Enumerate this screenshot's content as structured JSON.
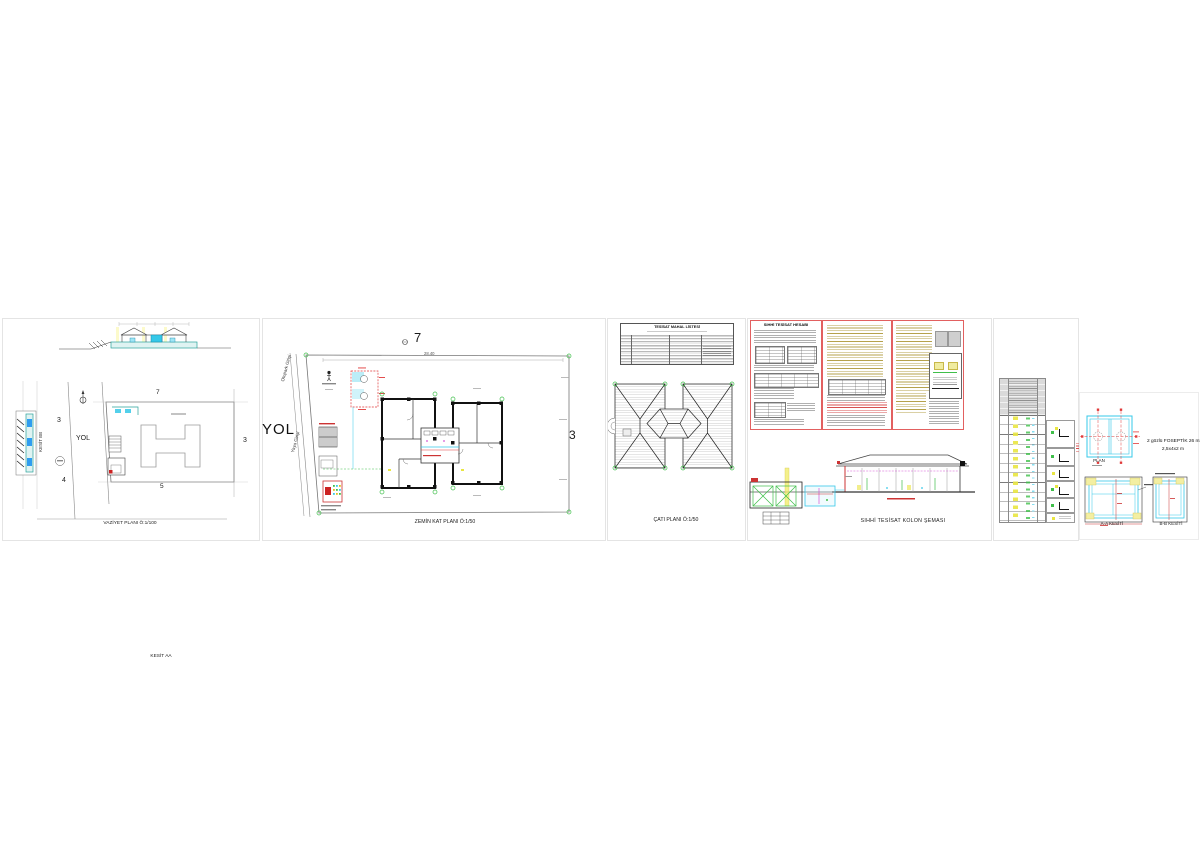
{
  "document": {
    "type": "architectural-drawing-sheet-set",
    "background": "#ffffff"
  },
  "panels": {
    "vaziyet": {
      "caption": "VAZİYET PLANI Ö:1/100",
      "section_a_label": "KESİT AA",
      "section_b_label": "KESİT BB",
      "road_label": "YOL",
      "parcel_top": "7",
      "parcel_left": "3",
      "parcel_right": "3",
      "parcel_bottom": "5",
      "parcel_bottom_left": "4"
    },
    "zemin": {
      "caption": "ZEMİN KAT PLANI Ö:1/50",
      "road_label": "YOL",
      "parcel_top": "7",
      "parcel_right": "3",
      "top_dimension": "28.40",
      "entrance_parking": "Otopark Girişi",
      "entrance_pedestrian": "Yaya Girişi"
    },
    "cati": {
      "caption": "ÇATI PLANI Ö:1/50",
      "schedule_title": "TESİSAT MAHAL LİSTESİ"
    },
    "kolon": {
      "caption": "SIHHİ TESİSAT KOLON ŞEMASI",
      "calc_box_title": "SIHHİ TESİSAT HESABI"
    },
    "foseptik": {
      "plan_label": "PLAN",
      "section_a_label": "A-A KESİTİ",
      "section_b_label": "B-B KESİTİ",
      "note_line1": "2 gözlü FOSEPTİK 26 m3",
      "note_line2": "2,5x4x2 m"
    }
  },
  "colors": {
    "teal": "#2aa39b",
    "cyan": "#35c8e8",
    "red": "#d23232",
    "green": "#3fbf4a",
    "yellow": "#e9e642",
    "magenta": "#d555d5",
    "olive": "#ae9838",
    "line_gray": "#8a8a8a"
  }
}
